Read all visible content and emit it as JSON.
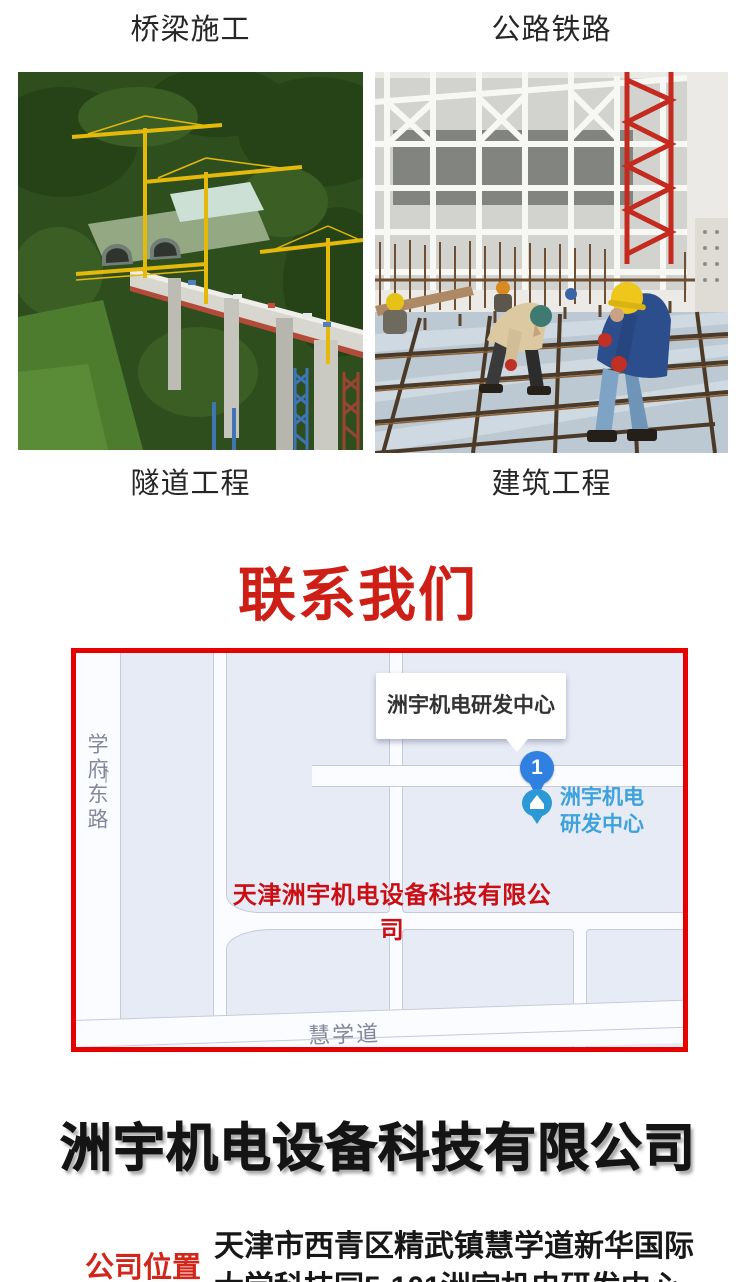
{
  "colors": {
    "heading_red": "#ce1f17",
    "map_border_red": "#e60000",
    "map_overlay_red": "#cb0e14",
    "marker_blue": "#2f80e0",
    "poi_text_blue": "#3ea2dc",
    "location_label_red": "#d3261b",
    "title_black": "#141414"
  },
  "gallery": {
    "caption_top_left": "桥梁施工",
    "caption_top_right": "公路铁路",
    "caption_bottom_left": "隧道工程",
    "caption_bottom_right": "建筑工程"
  },
  "contact": {
    "heading": "联系我们"
  },
  "map": {
    "tooltip_label": "洲宇机电研发中心",
    "marker_number": "1",
    "poi_line1": "洲宇机电",
    "poi_line2": "研发中心",
    "overlay_company": "天津洲宇机电设备科技有限公司",
    "road_left": "学府东路",
    "road_left_arrow": "↑",
    "road_bottom": "慧学道"
  },
  "company": {
    "title": "洲宇机电设备科技有限公司",
    "location_label": "公司位置",
    "address_line1": "天津市西青区精武镇慧学道新华国际",
    "address_line2": "大学科技园5-101洲宇机电研发中心"
  }
}
